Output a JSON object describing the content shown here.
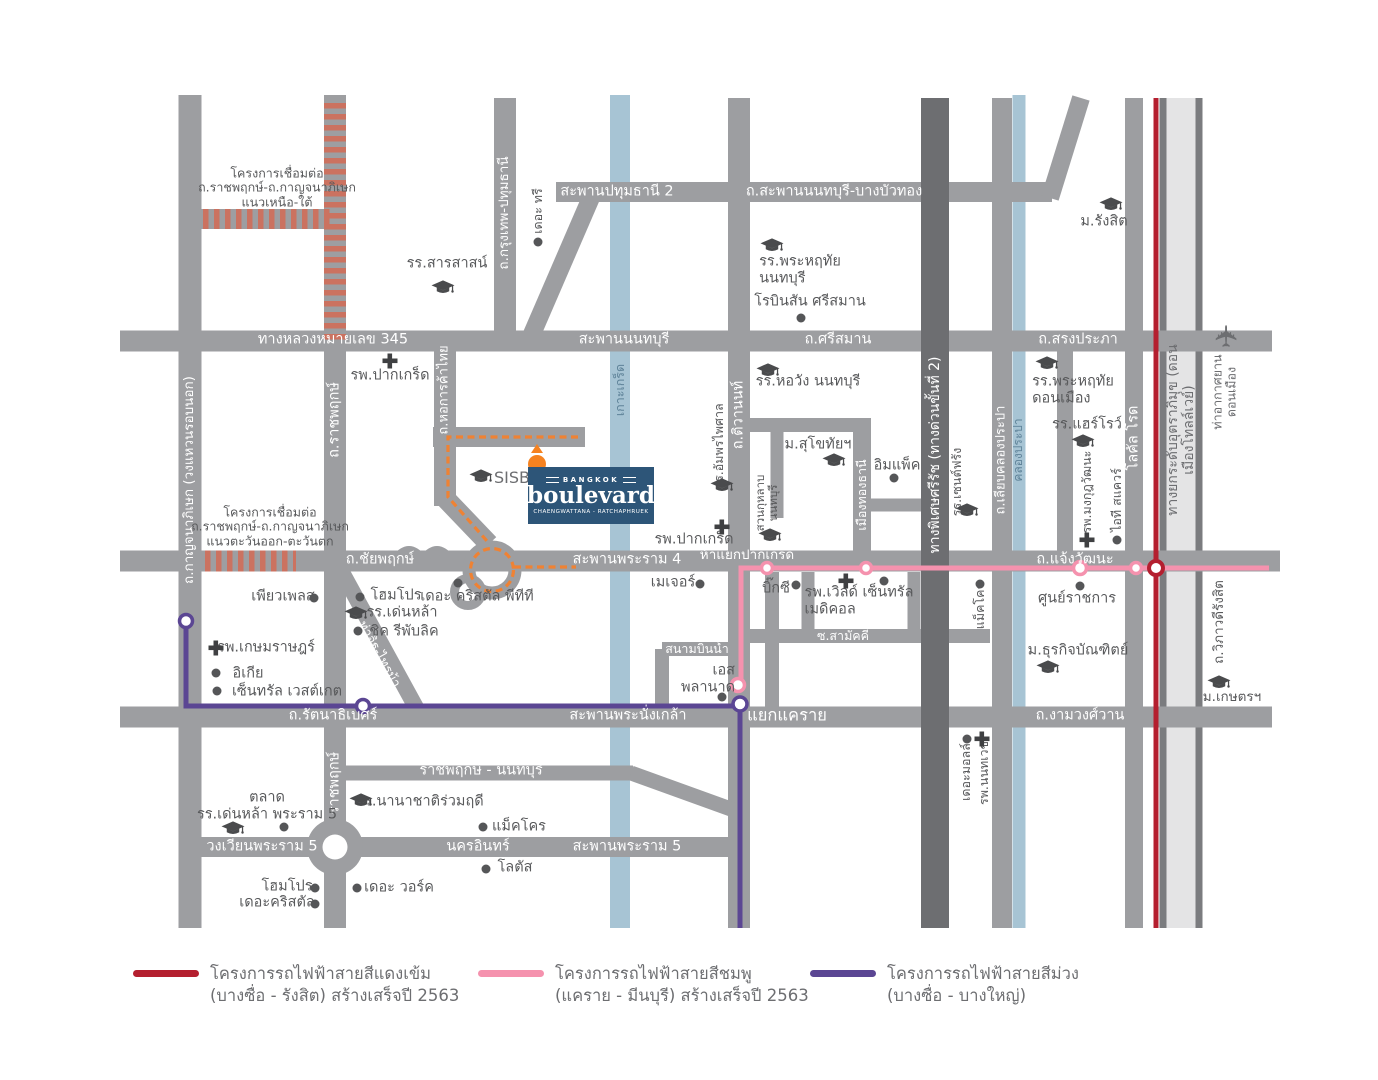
{
  "logo": {
    "top": "BANGKOK",
    "main": "boulevard",
    "sub": "CHAENGWATTANA - RATCHAPHRUEK"
  },
  "colors": {
    "road": "#9d9ea1",
    "expressway": "#6d6e71",
    "water": "#a7c4d4",
    "tollway_surface": "#e4e4e5",
    "tollway_edge": "#7b7c7f",
    "hatch": "#cb7260",
    "red_line": "#b41f2f",
    "pink_line": "#f592ae",
    "purple_line": "#5b4693",
    "orange_route": "#ef8233",
    "pin": "#f58220",
    "logo_bg": "#2d5578",
    "label_dark": "#58595b",
    "label_water": "#5f8399"
  },
  "legend": {
    "items": [
      {
        "color": "#b41f2f",
        "line1": "โครงการรถไฟฟ้าสายสีแดงเข้ม",
        "line2": "(บางซื่อ - รังสิต) สร้างเสร็จปี 2563"
      },
      {
        "color": "#f592ae",
        "line1": "โครงการรถไฟฟ้าสายสีชมพู",
        "line2": "(แคราย - มีนบุรี) สร้างเสร็จปี 2563"
      },
      {
        "color": "#5b4693",
        "line1": "โครงการรถไฟฟ้าสายสีม่วง",
        "line2": "(บางซื่อ - บางใหญ่)"
      }
    ]
  },
  "map": {
    "labels": [
      {
        "name": "label-hwy-345",
        "text": "ทางหลวงหมายเลข 345",
        "x": 333,
        "y": 340,
        "c": "w"
      },
      {
        "name": "label-saphan-nonthaburi",
        "text": "สะพานนนทบุรี",
        "x": 624,
        "y": 340,
        "c": "w"
      },
      {
        "name": "label-srisaman",
        "text": "ถ.ศรีสมาน",
        "x": 838,
        "y": 340,
        "c": "w"
      },
      {
        "name": "label-songprapa",
        "text": "ถ.สรงประภา",
        "x": 1078,
        "y": 340,
        "c": "w"
      },
      {
        "name": "label-saphan-pathumthani-2",
        "text": "สะพานปทุมธานี 2",
        "x": 617,
        "y": 192,
        "c": "w"
      },
      {
        "name": "label-saphan-nonthaburi-bangbuathong",
        "text": "ถ.สะพานนนทบุรี-บางบัวทอง",
        "x": 834,
        "y": 192,
        "c": "w"
      },
      {
        "name": "label-chaiyapruek",
        "text": "ถ.ชัยพฤกษ์",
        "x": 380,
        "y": 560,
        "c": "w"
      },
      {
        "name": "label-saphan-rama4",
        "text": "สะพานพระราม 4",
        "x": 627,
        "y": 560,
        "c": "w"
      },
      {
        "name": "label-ha-yaek-pakkret",
        "text": "ห้าแยกปากเกร็ด",
        "x": 747,
        "y": 556,
        "size": 13.5,
        "c": "w"
      },
      {
        "name": "label-chaengwattana",
        "text": "ถ.แจ้งวัฒนะ",
        "x": 1075,
        "y": 560,
        "c": "w"
      },
      {
        "name": "label-rattanathibet",
        "text": "ถ.รัตนาธิเบศร์",
        "x": 333,
        "y": 716,
        "c": "w"
      },
      {
        "name": "label-saphan-phranangklao",
        "text": "สะพานพระนั่งเกล้า",
        "x": 628,
        "y": 716,
        "c": "w"
      },
      {
        "name": "label-yaek-khae-rai",
        "text": "แยกแคราย",
        "x": 787,
        "y": 716,
        "size": 16.5,
        "c": "w"
      },
      {
        "name": "label-ngamwongwan",
        "text": "ถ.งามวงศ์วาน",
        "x": 1080,
        "y": 716,
        "c": "w"
      },
      {
        "name": "label-ratchaphruek-nonthaburi-road",
        "text": "ราชพฤกษ์ - นนทบุรี",
        "x": 481,
        "y": 771,
        "c": "w"
      },
      {
        "name": "label-wongwian-rama5",
        "text": "วงเวียนพระราม 5",
        "x": 262,
        "y": 847,
        "c": "w"
      },
      {
        "name": "label-nakhon-in",
        "text": "นครอินทร์",
        "x": 478,
        "y": 847,
        "c": "w"
      },
      {
        "name": "label-saphan-rama5",
        "text": "สะพานพระราม 5",
        "x": 627,
        "y": 847,
        "c": "w"
      },
      {
        "name": "label-sanambinnam",
        "text": "สนามบินน้ำ",
        "x": 697,
        "y": 649,
        "size": 12.5,
        "c": "w"
      },
      {
        "name": "label-soi-samakkhi",
        "text": "ซ.สามัคคี",
        "x": 843,
        "y": 636,
        "size": 12.5,
        "c": "w"
      },
      {
        "name": "label-kanchanaphisek",
        "text": "ถ.กาญจนาภิเษก (วงแหวนรอบนอก)",
        "x": 190,
        "y": 480,
        "rot": -90,
        "size": 13.5,
        "c": "w"
      },
      {
        "name": "label-ratchaphruek-upper",
        "text": "ถ.ราชพฤกษ์",
        "x": 335,
        "y": 420,
        "rot": -90,
        "c": "w"
      },
      {
        "name": "label-ratchaphruek-lower",
        "text": "ราชพฤกษ์",
        "x": 335,
        "y": 783,
        "rot": -90,
        "c": "w"
      },
      {
        "name": "label-hokankha-thai",
        "text": "ถ.หอการค้าไทย",
        "x": 445,
        "y": 390,
        "rot": -90,
        "size": 13,
        "c": "w"
      },
      {
        "name": "label-krungthep-pathumthani",
        "text": "ถ.กรุงเทพ-ปทุมธานี",
        "x": 505,
        "y": 213,
        "rot": -90,
        "size": 13.5,
        "c": "w"
      },
      {
        "name": "label-tiwanon",
        "text": "ถ.ติวานนท์",
        "x": 739,
        "y": 415,
        "rot": -90,
        "c": "w"
      },
      {
        "name": "label-muangthongthani",
        "text": "เมืองทองธานี",
        "x": 862,
        "y": 495,
        "rot": -90,
        "size": 12.5,
        "c": "w"
      },
      {
        "name": "label-srirat-expressway",
        "text": "ทางพิเศษศรีรัช (ทางด่วนขั้นที่ 2)",
        "x": 935,
        "y": 455,
        "rot": -90,
        "size": 14,
        "c": "w"
      },
      {
        "name": "label-liab-khlong-prapa",
        "text": "ถ.เลียบคลองประปา",
        "x": 1002,
        "y": 460,
        "rot": -90,
        "size": 13,
        "c": "w"
      },
      {
        "name": "label-local-road",
        "text": "โลคัล โรด",
        "x": 1134,
        "y": 438,
        "rot": -90,
        "c": "w"
      },
      {
        "name": "label-tha-it-sai-ma",
        "text": "ท่าอิฐ-ไทรม้า",
        "x": 378,
        "y": 655,
        "rot": 61,
        "size": 13,
        "c": "w"
      },
      {
        "name": "label-koh-kret",
        "text": "เกาะเกร็ด",
        "x": 620,
        "y": 390,
        "rot": -90,
        "size": 12.5,
        "c": "b"
      },
      {
        "name": "label-khlong-prapa",
        "text": "คลองประปา",
        "x": 1019,
        "y": 450,
        "rot": -90,
        "size": 12,
        "c": "b"
      },
      {
        "name": "label-tollway",
        "text": "ทางยกระดับอุตราภิมุข (ดอนเมืองโทลล์เวย์)",
        "x": 1181,
        "y": 430,
        "rot": -90,
        "size": 14,
        "c": "t"
      },
      {
        "name": "note-link-project-north-south",
        "text": "โครงการเชื่อมต่อ\nถ.ราชพฤกษ์-ถ.กาญจนาภิเษก\nแนวเหนือ-ใต้",
        "x": 277,
        "y": 188,
        "size": 12.5
      },
      {
        "name": "note-link-project-east-west",
        "text": "โครงการเชื่อมต่อ\nถ.ราชพฤกษ์-ถ.กาญจนาภิเษก\nแนวตะวันออก-ตะวันตก",
        "x": 270,
        "y": 527,
        "size": 12.5
      },
      {
        "name": "label-vibhavadi-rangsit",
        "text": "ถ.วิภาวดีรังสิต",
        "x": 1220,
        "y": 622,
        "rot": -90,
        "size": 13.5
      },
      {
        "name": "label-don-mueang-airport",
        "text": "ท่าอากาศยาน\nดอนเมือง",
        "x": 1225,
        "y": 392,
        "rot": -90,
        "size": 12.5,
        "c": "t"
      },
      {
        "name": "label-sisb",
        "text": "SISB",
        "x": 512,
        "y": 478,
        "size": 16,
        "c": "t"
      },
      {
        "name": "label-sarasas-school",
        "text": "รร.สารสาสน์",
        "x": 447,
        "y": 264
      },
      {
        "name": "label-phraharuthai-nonthaburi-school",
        "text": "รร.พระหฤทัย\nนนทบุรี",
        "x": 800,
        "y": 270,
        "align": "left"
      },
      {
        "name": "label-robinson-srisaman",
        "text": "โรบินสัน ศรีสมาน",
        "x": 810,
        "y": 302
      },
      {
        "name": "label-horwang-nonthaburi-school",
        "text": "รร.หอวัง นนทบุรี",
        "x": 808,
        "y": 382
      },
      {
        "name": "label-rangsit-university",
        "text": "ม.รังสิต",
        "x": 1104,
        "y": 222
      },
      {
        "name": "label-phraharuthai-donmueang-school",
        "text": "รร.พระหฤทัย\nดอนเมือง",
        "x": 1073,
        "y": 390,
        "align": "left"
      },
      {
        "name": "label-harrow-school",
        "text": "รร.แฮร์โรว์",
        "x": 1087,
        "y": 425
      },
      {
        "name": "label-sukhothai-university",
        "text": "ม.สุโขทัยฯ",
        "x": 818,
        "y": 445
      },
      {
        "name": "label-impact",
        "text": "อิมแพ็ค",
        "x": 897,
        "y": 466
      },
      {
        "name": "label-amphornpaisarn-school",
        "text": "รร.อัมพรไพศาล",
        "x": 719,
        "y": 446,
        "rot": -90,
        "size": 12.5
      },
      {
        "name": "label-suankularb-nonthaburi-school",
        "text": "สวนกุหลาบ\nนนทบุรี",
        "x": 767,
        "y": 503,
        "rot": -90,
        "size": 11.5
      },
      {
        "name": "label-saint-francis-school",
        "text": "รร.เซนต์ฟรัง",
        "x": 957,
        "y": 482,
        "rot": -90,
        "size": 12.5
      },
      {
        "name": "label-pakkret-hospital-west",
        "text": "รพ.ปากเกร็ด",
        "x": 390,
        "y": 376
      },
      {
        "name": "label-pakkret-hospital-east",
        "text": "รพ.ปากเกร็ด",
        "x": 694,
        "y": 540
      },
      {
        "name": "label-the-tree",
        "text": "เดอะ ทรี",
        "x": 538,
        "y": 211,
        "rot": -90,
        "size": 12.5
      },
      {
        "name": "label-major",
        "text": "เมเจอร์",
        "x": 673,
        "y": 583
      },
      {
        "name": "label-big-c",
        "text": "บิ๊กซี",
        "x": 776,
        "y": 589
      },
      {
        "name": "label-world-central-medical",
        "text": "รพ.เวิลด์ เซ็นทรัล\nเมดิคอล",
        "x": 859,
        "y": 601,
        "align": "left"
      },
      {
        "name": "label-esplanade",
        "text": "เอส\nพลานาด",
        "x": 708,
        "y": 679,
        "align": "right"
      },
      {
        "name": "label-government-complex",
        "text": "ศูนย์ราชการ",
        "x": 1077,
        "y": 599
      },
      {
        "name": "label-mongkutwattana-hospital",
        "text": "รพ.มงกุฎวัฒนะ",
        "x": 1087,
        "y": 492,
        "rot": -90,
        "size": 12.5
      },
      {
        "name": "label-it-square",
        "text": "ไอที สแควร์",
        "x": 1117,
        "y": 500,
        "rot": -90,
        "size": 12.5
      },
      {
        "name": "label-makro-chaengwattana",
        "text": "แม็คโคร",
        "x": 980,
        "y": 606,
        "rot": -90,
        "size": 12.5
      },
      {
        "name": "label-pure-place",
        "text": "เพียวเพลส",
        "x": 283,
        "y": 597
      },
      {
        "name": "label-homepro-chaiyapruek",
        "text": "โฮมโปร",
        "x": 396,
        "y": 596
      },
      {
        "name": "label-the-crystal-ptt",
        "text": "เดอะ คริสตัล พีทีที",
        "x": 477,
        "y": 597
      },
      {
        "name": "label-denla-school",
        "text": "รร.เด่นหล้า",
        "x": 402,
        "y": 613
      },
      {
        "name": "label-chic-republic",
        "text": "ชิค รีพับลิค",
        "x": 404,
        "y": 632
      },
      {
        "name": "label-kasemrad-hospital",
        "text": "รพ.เกษมราษฎร์",
        "x": 266,
        "y": 648
      },
      {
        "name": "label-ikea",
        "text": "อิเกีย",
        "x": 248,
        "y": 674
      },
      {
        "name": "label-central-westgate",
        "text": "เซ็นทรัล เวสต์เกต",
        "x": 287,
        "y": 692
      },
      {
        "name": "label-talad-denla-rama5",
        "text": "ตลาด\nรร.เด่นหล้า พระราม 5",
        "x": 267,
        "y": 806
      },
      {
        "name": "label-ruamrudee-international-school",
        "text": "รร.นานาชาติร่วมฤดี",
        "x": 420,
        "y": 802
      },
      {
        "name": "label-makro-nakhon-in",
        "text": "แม็คโคร",
        "x": 519,
        "y": 827
      },
      {
        "name": "label-lotus",
        "text": "โลตัส",
        "x": 515,
        "y": 868
      },
      {
        "name": "label-homepro-rama5",
        "text": "โฮมโปร",
        "x": 287,
        "y": 887
      },
      {
        "name": "label-the-crystal-rama5",
        "text": "เดอะคริสตัล",
        "x": 277,
        "y": 903
      },
      {
        "name": "label-the-walk",
        "text": "เดอะ วอร์ค",
        "x": 399,
        "y": 888
      },
      {
        "name": "label-the-mall",
        "text": "เดอะมอลล์",
        "x": 966,
        "y": 772,
        "rot": -90,
        "size": 12.5
      },
      {
        "name": "label-nonthavej-hospital",
        "text": "รพ.นนทเวช",
        "x": 984,
        "y": 773,
        "rot": -90,
        "size": 12.5
      },
      {
        "name": "label-dhurakij-pundit-university",
        "text": "ม.ธุรกิจบัณฑิตย์",
        "x": 1078,
        "y": 651
      },
      {
        "name": "label-kasetsart-university",
        "text": "ม.เกษตรฯ",
        "x": 1232,
        "y": 698,
        "size": 13.5
      }
    ],
    "icons": [
      {
        "name": "school-icon-sarasas",
        "type": "school",
        "x": 443,
        "y": 288
      },
      {
        "name": "school-icon-phraharuthai-nonthaburi",
        "type": "school",
        "x": 772,
        "y": 246
      },
      {
        "name": "school-icon-horwang",
        "type": "school",
        "x": 768,
        "y": 371
      },
      {
        "name": "school-icon-rangsit",
        "type": "school",
        "x": 1111,
        "y": 205
      },
      {
        "name": "school-icon-phraharuthai-donmueang",
        "type": "school",
        "x": 1047,
        "y": 364
      },
      {
        "name": "school-icon-harrow",
        "type": "school",
        "x": 1083,
        "y": 442
      },
      {
        "name": "school-icon-sukhothai",
        "type": "school",
        "x": 834,
        "y": 461
      },
      {
        "name": "school-icon-amphornpaisarn",
        "type": "school",
        "x": 722,
        "y": 486
      },
      {
        "name": "school-icon-suankularb",
        "type": "school",
        "x": 770,
        "y": 536
      },
      {
        "name": "school-icon-saint-francis",
        "type": "school",
        "x": 967,
        "y": 511
      },
      {
        "name": "school-icon-sisb",
        "type": "school",
        "x": 481,
        "y": 477
      },
      {
        "name": "school-icon-denla",
        "type": "school",
        "x": 356,
        "y": 614
      },
      {
        "name": "school-icon-ruamrudee",
        "type": "school",
        "x": 361,
        "y": 801
      },
      {
        "name": "school-icon-denla-rama5",
        "type": "school",
        "x": 233,
        "y": 829
      },
      {
        "name": "school-icon-dhurakij-pundit",
        "type": "school",
        "x": 1048,
        "y": 668
      },
      {
        "name": "school-icon-kasetsart",
        "type": "school",
        "x": 1219,
        "y": 683
      },
      {
        "name": "hospital-icon-pakkret-west",
        "type": "hospital",
        "x": 390,
        "y": 361
      },
      {
        "name": "hospital-icon-pakkret-east",
        "type": "hospital",
        "x": 722,
        "y": 527
      },
      {
        "name": "hospital-icon-kasemrad",
        "type": "hospital",
        "x": 216,
        "y": 648
      },
      {
        "name": "hospital-icon-world-central-medical",
        "type": "hospital",
        "x": 846,
        "y": 581
      },
      {
        "name": "hospital-icon-mongkutwattana",
        "type": "hospital",
        "x": 1087,
        "y": 540
      },
      {
        "name": "hospital-icon-nonthavej",
        "type": "hospital",
        "x": 982,
        "y": 739
      },
      {
        "name": "place-icon-the-tree",
        "type": "place",
        "x": 538,
        "y": 242
      },
      {
        "name": "place-icon-robinson",
        "type": "place",
        "x": 801,
        "y": 318
      },
      {
        "name": "place-icon-impact",
        "type": "place",
        "x": 894,
        "y": 478
      },
      {
        "name": "place-icon-major",
        "type": "place",
        "x": 700,
        "y": 584
      },
      {
        "name": "place-icon-big-c",
        "type": "place",
        "x": 796,
        "y": 585
      },
      {
        "name": "place-icon-world-central-medical",
        "type": "place",
        "x": 884,
        "y": 581
      },
      {
        "name": "place-icon-government-complex",
        "type": "place",
        "x": 1080,
        "y": 586
      },
      {
        "name": "place-icon-it-square",
        "type": "place",
        "x": 1117,
        "y": 540
      },
      {
        "name": "place-icon-makro-chaengwattana",
        "type": "place",
        "x": 980,
        "y": 584
      },
      {
        "name": "place-icon-pure-place",
        "type": "place",
        "x": 314,
        "y": 598
      },
      {
        "name": "place-icon-homepro-chaiyapruek",
        "type": "place",
        "x": 360,
        "y": 597
      },
      {
        "name": "place-icon-the-crystal-ptt",
        "type": "place",
        "x": 458,
        "y": 583
      },
      {
        "name": "place-icon-chic-republic",
        "type": "place",
        "x": 358,
        "y": 631
      },
      {
        "name": "place-icon-ikea",
        "type": "place",
        "x": 216,
        "y": 673
      },
      {
        "name": "place-icon-central-westgate",
        "type": "place",
        "x": 217,
        "y": 691
      },
      {
        "name": "place-icon-esplanade",
        "type": "place",
        "x": 722,
        "y": 697
      },
      {
        "name": "place-icon-the-mall",
        "type": "place",
        "x": 967,
        "y": 739
      },
      {
        "name": "place-icon-talad-rama5",
        "type": "place",
        "x": 284,
        "y": 827
      },
      {
        "name": "place-icon-makro-nakhon-in",
        "type": "place",
        "x": 483,
        "y": 827
      },
      {
        "name": "place-icon-lotus",
        "type": "place",
        "x": 486,
        "y": 869
      },
      {
        "name": "place-icon-homepro-rama5",
        "type": "place",
        "x": 315,
        "y": 888
      },
      {
        "name": "place-icon-the-crystal-rama5",
        "type": "place",
        "x": 315,
        "y": 904
      },
      {
        "name": "place-icon-the-walk",
        "type": "place",
        "x": 357,
        "y": 888
      },
      {
        "name": "airplane-icon-don-mueang",
        "type": "plane",
        "x": 1228,
        "y": 336
      }
    ]
  }
}
